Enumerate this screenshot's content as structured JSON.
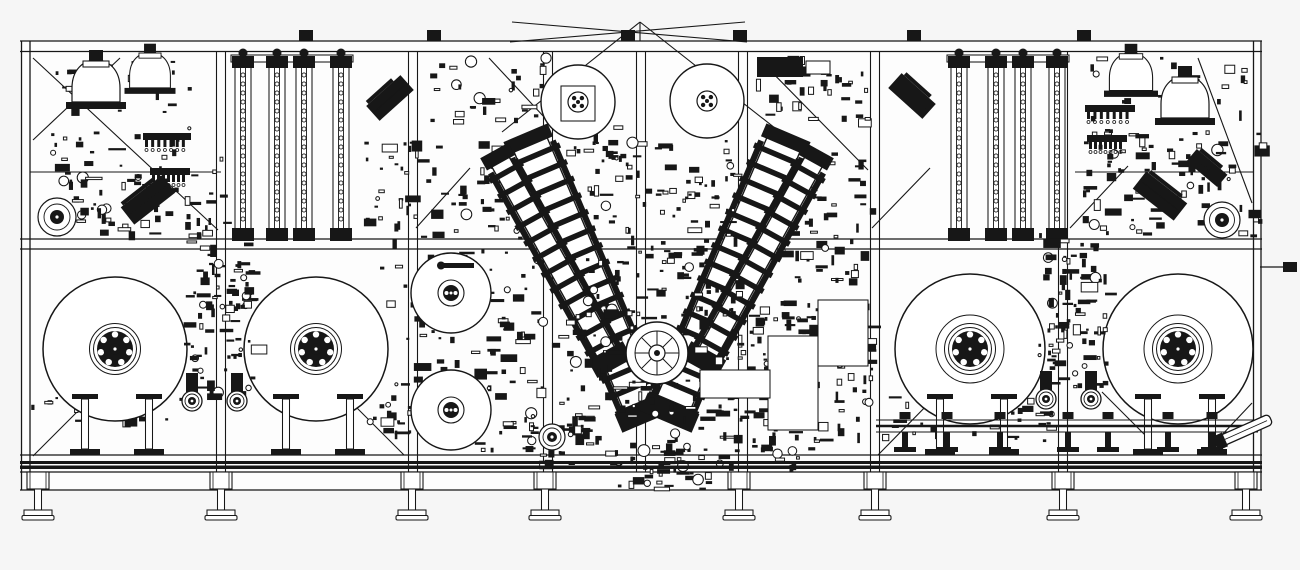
{
  "drawing": {
    "title": "industrial-machine-elevation-cad-drawing",
    "width": 1300,
    "height": 570,
    "colors": {
      "background": "#f6f6f6",
      "paper": "#fdfdfd",
      "ink": "#171717"
    },
    "frame": {
      "x0": 20,
      "x1": 1262,
      "paper_rect": [
        20,
        41,
        1242,
        449
      ],
      "h_rails": [
        [
          20,
          41,
          1262
        ],
        [
          20,
          51.5,
          1262
        ],
        [
          20,
          239,
          1262
        ],
        [
          20,
          249,
          1262
        ],
        [
          20,
          455,
          1262
        ],
        [
          20,
          472,
          1262
        ],
        [
          20,
          490,
          1262
        ]
      ],
      "h_segments": [
        [
          30,
          172,
          221
        ],
        [
          1075,
          172,
          1253
        ]
      ],
      "edge_posts": [
        21.5,
        30,
        1253.5,
        1261
      ],
      "posts": [
        221,
        413,
        548,
        641,
        743,
        875,
        1063
      ],
      "dark_bands": [
        [
          461,
          3.0
        ],
        [
          465.5,
          3.5
        ]
      ],
      "top_tabs": [
        306,
        434,
        628,
        740,
        914,
        1084
      ],
      "diagonals": [
        [
          33,
          58,
          218,
          230
        ],
        [
          120,
          58,
          33,
          140
        ],
        [
          416,
          228,
          470,
          168
        ],
        [
          489,
          58,
          545,
          118
        ],
        [
          758,
          58,
          868,
          170
        ],
        [
          872,
          228,
          930,
          168
        ],
        [
          1070,
          228,
          1128,
          166
        ],
        [
          1198,
          58,
          1252,
          203
        ],
        [
          510,
          42,
          745,
          22
        ],
        [
          512,
          22,
          747,
          42
        ],
        [
          640,
          22,
          502,
          132
        ],
        [
          640,
          22,
          780,
          132
        ],
        [
          640,
          22,
          640,
          41
        ],
        [
          33,
          456,
          90,
          399
        ],
        [
          348,
          399,
          404,
          455
        ],
        [
          878,
          455,
          934,
          398
        ],
        [
          1102,
          392,
          1151,
          441
        ],
        [
          1252,
          403,
          1203,
          455
        ]
      ]
    },
    "reels": {
      "items": [
        {
          "cx": 115,
          "cy": 349,
          "r": 72,
          "rings": [
            25.5,
            21.5
          ]
        },
        {
          "cx": 316,
          "cy": 349,
          "r": 72,
          "rings": [
            25.5,
            21.5
          ]
        },
        {
          "cx": 970,
          "cy": 349,
          "r": 75,
          "rings": [
            34,
            25.5,
            21.5
          ]
        },
        {
          "cx": 1178,
          "cy": 349,
          "r": 75,
          "rings": [
            34,
            25.5,
            21.5
          ]
        }
      ],
      "hub": {
        "dark_r": 18,
        "white_r": 11,
        "bolt_ring_r": 14.5,
        "bolt_r": 3.2,
        "bolts": 7,
        "center_r": 5.5
      }
    },
    "reel_stands": {
      "y_top": 394,
      "y_base": 449,
      "offsets": [
        -30,
        34
      ],
      "centers": [
        115,
        316,
        970,
        1178
      ]
    },
    "guide_rollers": {
      "r_out": 10,
      "r_mid": 7,
      "r_in": 4,
      "items": [
        [
          192,
          401
        ],
        [
          237,
          401
        ],
        [
          1046,
          399
        ],
        [
          1091,
          399
        ]
      ]
    },
    "mid_rolls": {
      "r": 40,
      "items": [
        [
          451,
          293
        ],
        [
          451,
          410
        ]
      ]
    },
    "small_rolls": [
      [
        57,
        217,
        19,
        7
      ],
      [
        1222,
        220,
        18,
        7
      ],
      [
        552,
        437,
        13,
        5
      ]
    ],
    "top_rolls": {
      "r": 37,
      "items": [
        {
          "cx": 578,
          "cy": 102,
          "plate": true
        },
        {
          "cx": 707,
          "cy": 101,
          "plate": false
        }
      ]
    },
    "ladders": {
      "y0": 62,
      "y1": 232,
      "w": 16,
      "bead_r": 2.1,
      "bead_step": 9,
      "left": [
        243,
        277,
        304,
        341
      ],
      "right": [
        959,
        996,
        1023,
        1057
      ],
      "headers": [
        [
          231,
          55,
          122
        ],
        [
          947,
          55,
          122
        ]
      ]
    },
    "domes": [
      [
        96,
        88,
        1
      ],
      [
        150,
        76,
        0.85
      ],
      [
        1131,
        78,
        0.9
      ],
      [
        1185,
        104,
        1
      ]
    ],
    "combs": [
      [
        143,
        133,
        48
      ],
      [
        150,
        168,
        40
      ],
      [
        1085,
        105,
        50
      ],
      [
        1087,
        135,
        40
      ]
    ],
    "arms": [
      {
        "cx": 588,
        "cy": 280,
        "len": 300,
        "w": 36,
        "angle": -23
      },
      {
        "cx": 556,
        "cy": 262,
        "len": 235,
        "w": 20,
        "angle": -29
      },
      {
        "cx": 726,
        "cy": 280,
        "len": 300,
        "w": 36,
        "angle": 23
      },
      {
        "cx": 758,
        "cy": 262,
        "len": 235,
        "w": 20,
        "angle": 29
      }
    ],
    "turret": {
      "cx": 657,
      "cy": 353,
      "r": 31,
      "r2": 22,
      "spokes": 8,
      "hub_r": 8
    },
    "clusters_back": [
      [
        50,
        128,
        175,
        108,
        85,
        1
      ],
      [
        362,
        140,
        190,
        100,
        75,
        2
      ],
      [
        370,
        248,
        182,
        188,
        120,
        5
      ],
      [
        762,
        148,
        108,
        135,
        60,
        6
      ],
      [
        1082,
        128,
        180,
        108,
        85,
        7
      ],
      [
        425,
        58,
        125,
        62,
        32,
        8
      ],
      [
        752,
        55,
        118,
        70,
        35,
        9
      ],
      [
        55,
        55,
        165,
        68,
        24,
        14
      ],
      [
        1088,
        55,
        160,
        66,
        22,
        15
      ],
      [
        560,
        118,
        62,
        42,
        18,
        16
      ],
      [
        470,
        415,
        120,
        48,
        32,
        17
      ],
      [
        762,
        300,
        108,
        140,
        66,
        13
      ],
      [
        876,
        392,
        180,
        48,
        36,
        18
      ],
      [
        30,
        392,
        150,
        30,
        18,
        19
      ]
    ],
    "clusters_front": [
      [
        585,
        138,
        152,
        175,
        120,
        3
      ],
      [
        558,
        300,
        255,
        168,
        190,
        4
      ],
      [
        182,
        230,
        70,
        164,
        86,
        11
      ],
      [
        1038,
        230,
        68,
        158,
        86,
        12
      ],
      [
        615,
        442,
        95,
        46,
        32,
        10
      ]
    ],
    "panels": [
      [
        768,
        336,
        50,
        94
      ],
      [
        700,
        370,
        70,
        28
      ],
      [
        818,
        300,
        50,
        66
      ]
    ],
    "angled_blocks": [
      [
        148,
        200,
        52,
        22,
        -38
      ],
      [
        390,
        98,
        46,
        20,
        -42
      ],
      [
        1160,
        196,
        52,
        22,
        38
      ],
      [
        912,
        96,
        46,
        20,
        42
      ],
      [
        1207,
        168,
        40,
        16,
        40
      ]
    ],
    "dark_boxes": [
      {
        "r": [
          757,
          57,
          46,
          20
        ],
        "fill": true
      },
      {
        "r": [
          806,
          61,
          24,
          13
        ],
        "fill": false
      }
    ],
    "conveyor": {
      "x0": 876,
      "x1": 1258,
      "rail_ys": [
        420,
        426,
        432
      ],
      "stands": [
        905,
        947,
        1000,
        1068,
        1108,
        1168,
        1212
      ],
      "nozzle": {
        "cx": 1246,
        "cy": 430,
        "angle": -24,
        "len": 54,
        "w": 11
      }
    },
    "stub": {
      "line": [
        1260,
        267,
        1283,
        267
      ],
      "rect": [
        1283,
        262,
        14,
        10
      ]
    },
    "probe": {
      "rect": [
        444,
        263,
        30,
        5
      ],
      "ball": [
        441,
        265.5,
        4
      ]
    },
    "feet": {
      "xs": [
        38,
        221,
        412,
        545,
        739,
        875,
        1063,
        1246
      ],
      "block": [
        22,
        17
      ],
      "stem": [
        7,
        21
      ],
      "pad_w": 28,
      "pad2_w": 32
    }
  }
}
